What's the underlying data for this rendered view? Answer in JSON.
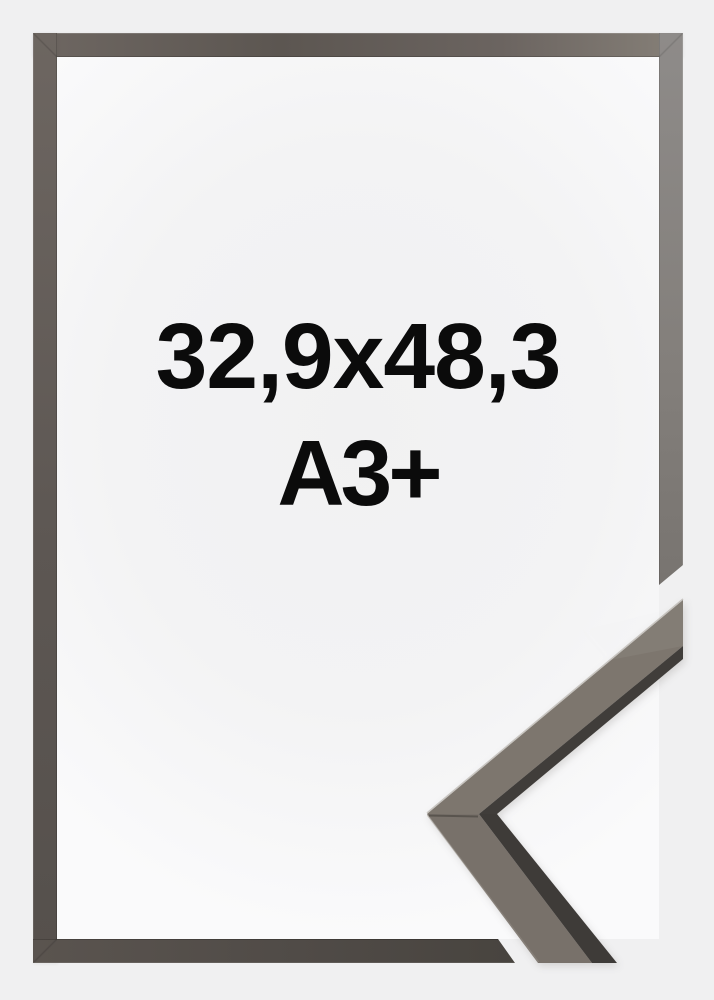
{
  "size_label": {
    "dimensions": "32,9x48,3",
    "format": "A3+"
  },
  "colors": {
    "page_background": "#f0f0f1",
    "opening_backdrop": "#f2f2f3",
    "frame_graphite_dark": "#5c5651",
    "frame_graphite_light": "#8e8b89",
    "sample_face": "#7b746c",
    "sample_inner_edge": "#3f3c39",
    "label_text": "#0b0b0b"
  }
}
